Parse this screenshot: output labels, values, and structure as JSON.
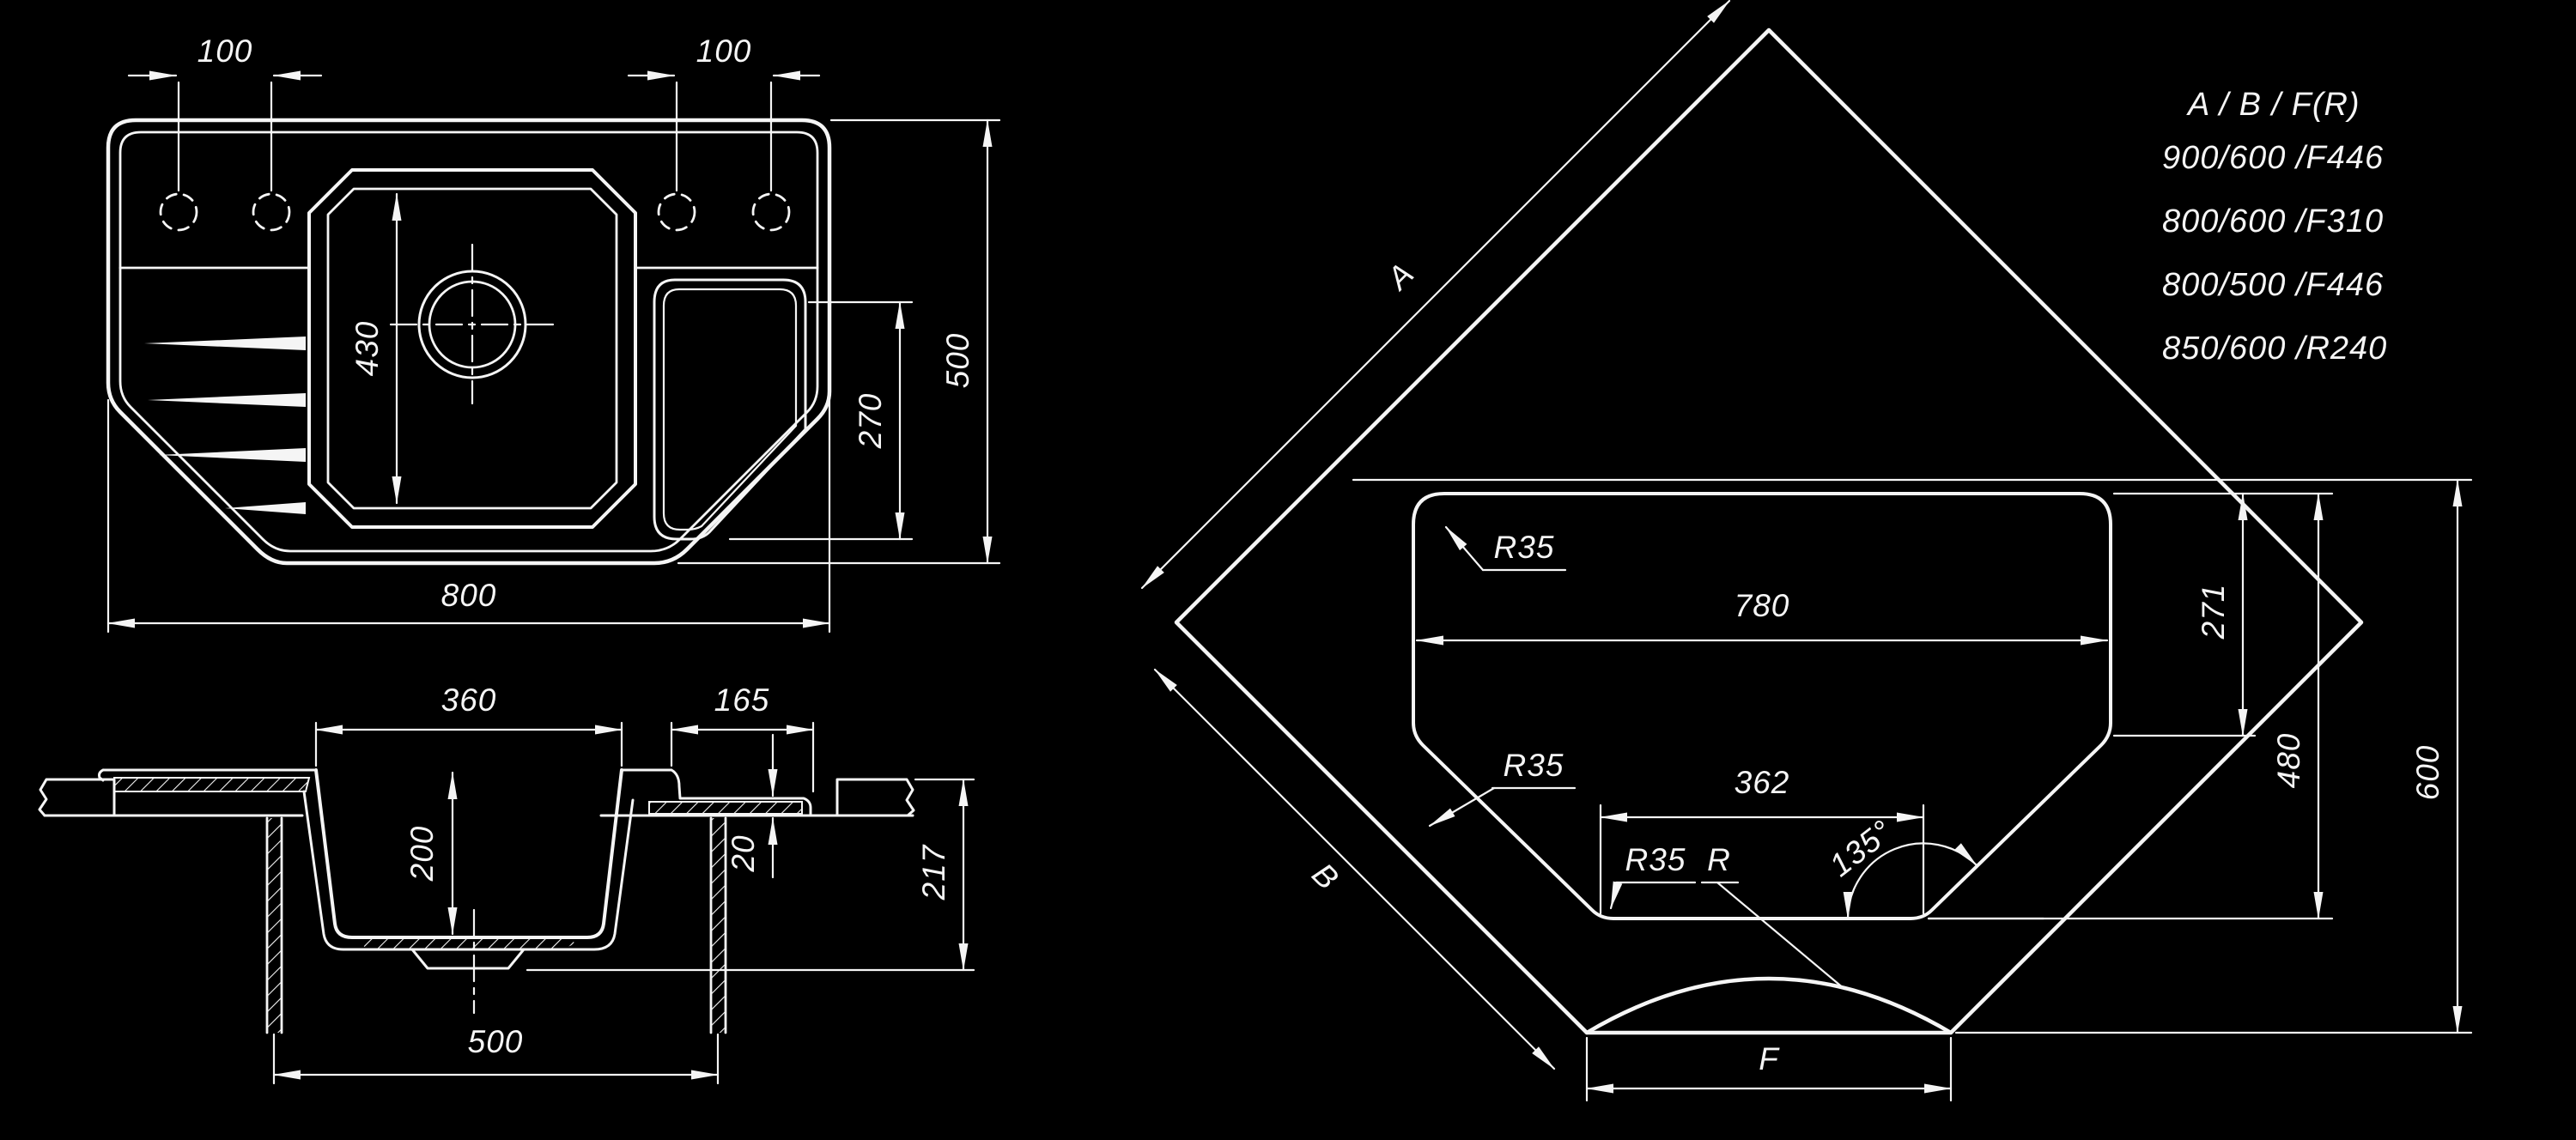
{
  "colors": {
    "background": "#000000",
    "line": "#f5f5f5"
  },
  "plan_view": {
    "dim_hole_spacing_left": "100",
    "dim_hole_spacing_right": "100",
    "dim_bowl_length": "430",
    "dim_drainer_length": "270",
    "dim_overall_depth": "500",
    "dim_overall_width": "800"
  },
  "section_view": {
    "dim_bowl_top_width": "360",
    "dim_wing_width": "165",
    "dim_bowl_depth": "200",
    "dim_step": "20",
    "dim_total_height": "217",
    "dim_cabinet_width": "500"
  },
  "corner_view": {
    "dim_cutout_width": "780",
    "radius_label": "R35",
    "dim_flat_bottom": "362",
    "dim_angle": "135°",
    "dim_side_height": "271",
    "dim_cutout_depth": "480",
    "dim_counter_depth": "600",
    "label_edge_a": "A",
    "label_edge_b": "B",
    "label_front_f": "F",
    "label_front_radius": "R"
  },
  "legend": {
    "header": "A / B / F(R)",
    "rows": [
      "900/600 /F446",
      "800/600 /F310",
      "800/500 /F446",
      "850/600 /R240"
    ]
  }
}
